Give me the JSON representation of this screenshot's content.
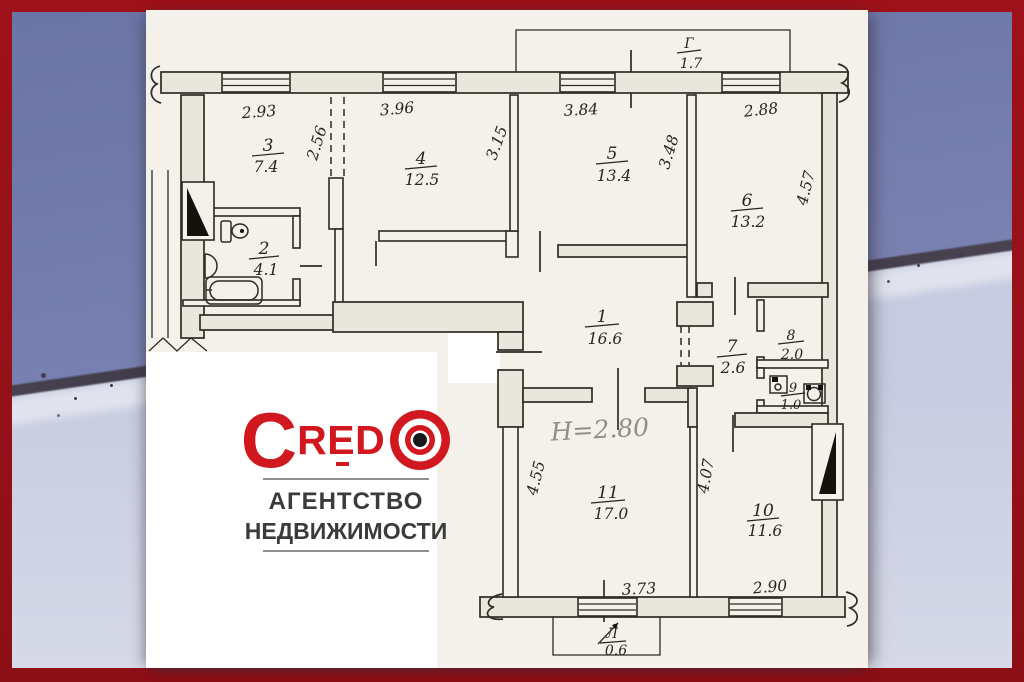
{
  "agency": {
    "brand_c": "C",
    "brand_word": "RED",
    "tagline_line1": "АГЕНТСТВО",
    "tagline_line2": "НЕДВИЖИМОСТИ",
    "brand_color": "#d2181f",
    "frame_color": "#951119"
  },
  "plan": {
    "height_note": "H=2.80",
    "balcony_top": {
      "label": "Г",
      "area": "1.7"
    },
    "balcony_bottom": {
      "label": "Л",
      "area": "0.6"
    },
    "rooms": {
      "r1": {
        "num": "1",
        "area": "16.6"
      },
      "r2": {
        "num": "2",
        "area": "4.1"
      },
      "r3": {
        "num": "3",
        "area": "7.4"
      },
      "r4": {
        "num": "4",
        "area": "12.5"
      },
      "r5": {
        "num": "5",
        "area": "13.4"
      },
      "r6": {
        "num": "6",
        "area": "13.2"
      },
      "r7": {
        "num": "7",
        "area": "2.6"
      },
      "r8": {
        "num": "8",
        "area": "2.0"
      },
      "r9": {
        "num": "9",
        "area": "1.0"
      },
      "r10": {
        "num": "10",
        "area": "11.6"
      },
      "r11": {
        "num": "11",
        "area": "17.0"
      }
    },
    "dims": {
      "top_293": "2.93",
      "top_396": "3.96",
      "top_384": "3.84",
      "top_288": "2.88",
      "v_256": "2.56",
      "v_315": "3.15",
      "v_348": "3.48",
      "v_457": "4.57",
      "v_455": "4.55",
      "v_407": "4.07",
      "bottom_373": "3.73",
      "bottom_290": "2.90"
    }
  }
}
